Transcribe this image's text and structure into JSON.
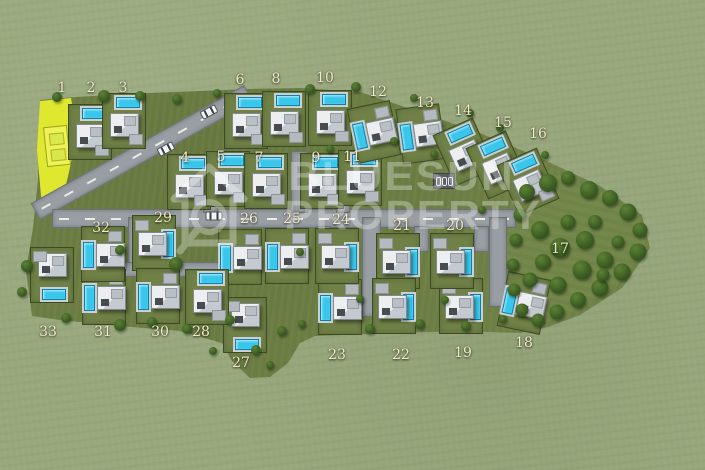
{
  "image_type": "villa development site master plan (top-down 3D render)",
  "watermark": {
    "line1": "BLUESUN",
    "line2": "PROPERTY"
  },
  "colors": {
    "grass_outside": "#99a87d",
    "grass_site": "#6e8045",
    "forest": "#75884b",
    "road": "#989ea3",
    "pool": "#38c6ea",
    "highlight": "#dfe72f",
    "label": "#f0ebc5"
  },
  "lots": [
    {
      "n": "1",
      "x": 62,
      "y": 88,
      "highlighted": true
    },
    {
      "n": "2",
      "x": 91,
      "y": 88
    },
    {
      "n": "3",
      "x": 123,
      "y": 88
    },
    {
      "n": "4",
      "x": 185,
      "y": 158
    },
    {
      "n": "5",
      "x": 221,
      "y": 157
    },
    {
      "n": "6",
      "x": 240,
      "y": 80
    },
    {
      "n": "7",
      "x": 259,
      "y": 158
    },
    {
      "n": "8",
      "x": 276,
      "y": 79
    },
    {
      "n": "9",
      "x": 316,
      "y": 158
    },
    {
      "n": "10",
      "x": 325,
      "y": 78
    },
    {
      "n": "11",
      "x": 352,
      "y": 157
    },
    {
      "n": "12",
      "x": 378,
      "y": 92
    },
    {
      "n": "13",
      "x": 425,
      "y": 103
    },
    {
      "n": "14",
      "x": 463,
      "y": 111
    },
    {
      "n": "15",
      "x": 503,
      "y": 123
    },
    {
      "n": "16",
      "x": 538,
      "y": 134
    },
    {
      "n": "17",
      "x": 560,
      "y": 249
    },
    {
      "n": "18",
      "x": 524,
      "y": 343
    },
    {
      "n": "19",
      "x": 463,
      "y": 353
    },
    {
      "n": "20",
      "x": 455,
      "y": 226
    },
    {
      "n": "21",
      "x": 402,
      "y": 226
    },
    {
      "n": "22",
      "x": 401,
      "y": 355
    },
    {
      "n": "23",
      "x": 337,
      "y": 355
    },
    {
      "n": "24",
      "x": 341,
      "y": 220
    },
    {
      "n": "25",
      "x": 292,
      "y": 219
    },
    {
      "n": "26",
      "x": 249,
      "y": 219
    },
    {
      "n": "27",
      "x": 241,
      "y": 363
    },
    {
      "n": "28",
      "x": 201,
      "y": 332
    },
    {
      "n": "29",
      "x": 163,
      "y": 218
    },
    {
      "n": "30",
      "x": 160,
      "y": 332
    },
    {
      "n": "31",
      "x": 103,
      "y": 332
    },
    {
      "n": "32",
      "x": 101,
      "y": 228
    },
    {
      "n": "33",
      "x": 48,
      "y": 332
    }
  ],
  "villas": [
    {
      "lot": "2",
      "x": 90,
      "y": 132,
      "rot": 0,
      "pool": "top"
    },
    {
      "lot": "3",
      "x": 124,
      "y": 121,
      "rot": 0,
      "pool": "top"
    },
    {
      "lot": "4",
      "x": 189,
      "y": 182,
      "rot": 0,
      "pool": "top"
    },
    {
      "lot": "5",
      "x": 228,
      "y": 179,
      "rot": 0,
      "pool": "top"
    },
    {
      "lot": "6",
      "x": 246,
      "y": 121,
      "rot": 0,
      "pool": "top"
    },
    {
      "lot": "7",
      "x": 266,
      "y": 181,
      "rot": 0,
      "pool": "top"
    },
    {
      "lot": "8",
      "x": 284,
      "y": 119,
      "rot": 0,
      "pool": "top"
    },
    {
      "lot": "9",
      "x": 322,
      "y": 181,
      "rot": 0,
      "pool": "top"
    },
    {
      "lot": "10",
      "x": 330,
      "y": 118,
      "rot": 0,
      "pool": "top"
    },
    {
      "lot": "11",
      "x": 360,
      "y": 178,
      "rot": 0,
      "pool": "top"
    },
    {
      "lot": "12",
      "x": 374,
      "y": 132,
      "rot": -12,
      "pool": "left"
    },
    {
      "lot": "13",
      "x": 421,
      "y": 134,
      "rot": -8,
      "pool": "left"
    },
    {
      "lot": "14",
      "x": 464,
      "y": 152,
      "rot": -24,
      "pool": "top"
    },
    {
      "lot": "15",
      "x": 497,
      "y": 165,
      "rot": -24,
      "pool": "top"
    },
    {
      "lot": "16",
      "x": 528,
      "y": 182,
      "rot": -24,
      "pool": "top"
    },
    {
      "lot": "18",
      "x": 524,
      "y": 303,
      "rot": 12,
      "pool": "left"
    },
    {
      "lot": "19",
      "x": 461,
      "y": 306,
      "rot": 0,
      "pool": "right"
    },
    {
      "lot": "20",
      "x": 452,
      "y": 261,
      "rot": 0,
      "pool": "right"
    },
    {
      "lot": "21",
      "x": 398,
      "y": 261,
      "rot": 0,
      "pool": "right"
    },
    {
      "lot": "22",
      "x": 394,
      "y": 306,
      "rot": 0,
      "pool": "right"
    },
    {
      "lot": "23",
      "x": 340,
      "y": 307,
      "rot": 0,
      "pool": "left"
    },
    {
      "lot": "24",
      "x": 337,
      "y": 256,
      "rot": 0,
      "pool": "right"
    },
    {
      "lot": "25",
      "x": 287,
      "y": 256,
      "rot": 0,
      "pool": "left"
    },
    {
      "lot": "26",
      "x": 240,
      "y": 257,
      "rot": 0,
      "pool": "left"
    },
    {
      "lot": "27",
      "x": 245,
      "y": 325,
      "rot": 0,
      "pool": "bottom"
    },
    {
      "lot": "28",
      "x": 207,
      "y": 297,
      "rot": 0,
      "pool": "top"
    },
    {
      "lot": "29",
      "x": 154,
      "y": 243,
      "rot": 0,
      "pool": "right"
    },
    {
      "lot": "30",
      "x": 158,
      "y": 296,
      "rot": 0,
      "pool": "left"
    },
    {
      "lot": "31",
      "x": 104,
      "y": 297,
      "rot": 0,
      "pool": "left"
    },
    {
      "lot": "32",
      "x": 103,
      "y": 254,
      "rot": 0,
      "pool": "left"
    },
    {
      "lot": "33",
      "x": 52,
      "y": 275,
      "rot": 0,
      "pool": "bottom"
    }
  ],
  "roads": [
    {
      "x": 20,
      "y": 143,
      "w": 242,
      "h": 17,
      "rot": -29,
      "dashed": true
    },
    {
      "x": 52,
      "y": 209,
      "w": 462,
      "h": 17,
      "rot": 0,
      "dashed": true
    },
    {
      "x": 362,
      "y": 217,
      "w": 17,
      "h": 98,
      "rot": 0
    },
    {
      "x": 291,
      "y": 151,
      "w": 15,
      "h": 60,
      "rot": 0
    },
    {
      "x": 489,
      "y": 217,
      "w": 16,
      "h": 88,
      "rot": 0
    },
    {
      "x": 128,
      "y": 217,
      "w": 15,
      "h": 56,
      "rot": 0
    },
    {
      "x": 118,
      "y": 262,
      "w": 100,
      "h": 13,
      "rot": 0
    },
    {
      "x": 203,
      "y": 164,
      "w": 13,
      "h": 47,
      "rot": 0
    },
    {
      "x": 336,
      "y": 158,
      "w": 12,
      "h": 53,
      "rot": 0
    },
    {
      "x": 316,
      "y": 226,
      "w": 13,
      "h": 24,
      "rot": 0
    },
    {
      "x": 414,
      "y": 226,
      "w": 13,
      "h": 24,
      "rot": 0
    },
    {
      "x": 474,
      "y": 226,
      "w": 13,
      "h": 24,
      "rot": 0
    }
  ],
  "trees": [
    [
      527,
      192,
      16
    ],
    [
      548,
      183,
      18
    ],
    [
      568,
      178,
      14
    ],
    [
      589,
      190,
      18
    ],
    [
      610,
      198,
      16
    ],
    [
      628,
      212,
      17
    ],
    [
      640,
      230,
      15
    ],
    [
      638,
      252,
      17
    ],
    [
      622,
      272,
      17
    ],
    [
      600,
      288,
      17
    ],
    [
      578,
      300,
      16
    ],
    [
      557,
      312,
      15
    ],
    [
      538,
      320,
      13
    ],
    [
      522,
      310,
      13
    ],
    [
      514,
      290,
      13
    ],
    [
      513,
      265,
      13
    ],
    [
      516,
      240,
      13
    ],
    [
      520,
      215,
      13
    ],
    [
      540,
      230,
      18
    ],
    [
      560,
      248,
      20
    ],
    [
      585,
      240,
      18
    ],
    [
      605,
      260,
      17
    ],
    [
      582,
      270,
      19
    ],
    [
      558,
      285,
      17
    ],
    [
      543,
      262,
      16
    ],
    [
      568,
      222,
      15
    ],
    [
      595,
      222,
      14
    ],
    [
      618,
      242,
      13
    ],
    [
      603,
      275,
      13
    ],
    [
      530,
      280,
      15
    ],
    [
      57,
      97,
      10
    ],
    [
      104,
      96,
      12
    ],
    [
      140,
      96,
      10
    ],
    [
      177,
      99,
      10
    ],
    [
      217,
      93,
      8
    ],
    [
      310,
      89,
      10
    ],
    [
      356,
      87,
      10
    ],
    [
      414,
      98,
      8
    ],
    [
      470,
      113,
      8
    ],
    [
      500,
      128,
      8
    ],
    [
      330,
      149,
      8
    ],
    [
      394,
      141,
      8
    ],
    [
      434,
      154,
      8
    ],
    [
      176,
      264,
      14
    ],
    [
      120,
      250,
      10
    ],
    [
      27,
      266,
      12
    ],
    [
      22,
      292,
      10
    ],
    [
      66,
      318,
      10
    ],
    [
      120,
      325,
      12
    ],
    [
      152,
      322,
      10
    ],
    [
      187,
      329,
      10
    ],
    [
      230,
      320,
      10
    ],
    [
      282,
      331,
      10
    ],
    [
      302,
      324,
      8
    ],
    [
      370,
      329,
      10
    ],
    [
      420,
      324,
      10
    ],
    [
      466,
      326,
      10
    ],
    [
      503,
      319,
      8
    ],
    [
      256,
      350,
      10
    ],
    [
      270,
      365,
      8
    ],
    [
      213,
      351,
      8
    ],
    [
      360,
      299,
      8
    ],
    [
      300,
      252,
      8
    ],
    [
      445,
      300,
      8
    ],
    [
      482,
      210,
      8
    ],
    [
      545,
      155,
      8
    ]
  ],
  "cars": [
    {
      "x": 166,
      "y": 149,
      "rot": -28
    },
    {
      "x": 209,
      "y": 112,
      "rot": -28
    },
    {
      "x": 214,
      "y": 216,
      "rot": 0
    }
  ],
  "carport": {
    "x": 444,
    "y": 181
  }
}
